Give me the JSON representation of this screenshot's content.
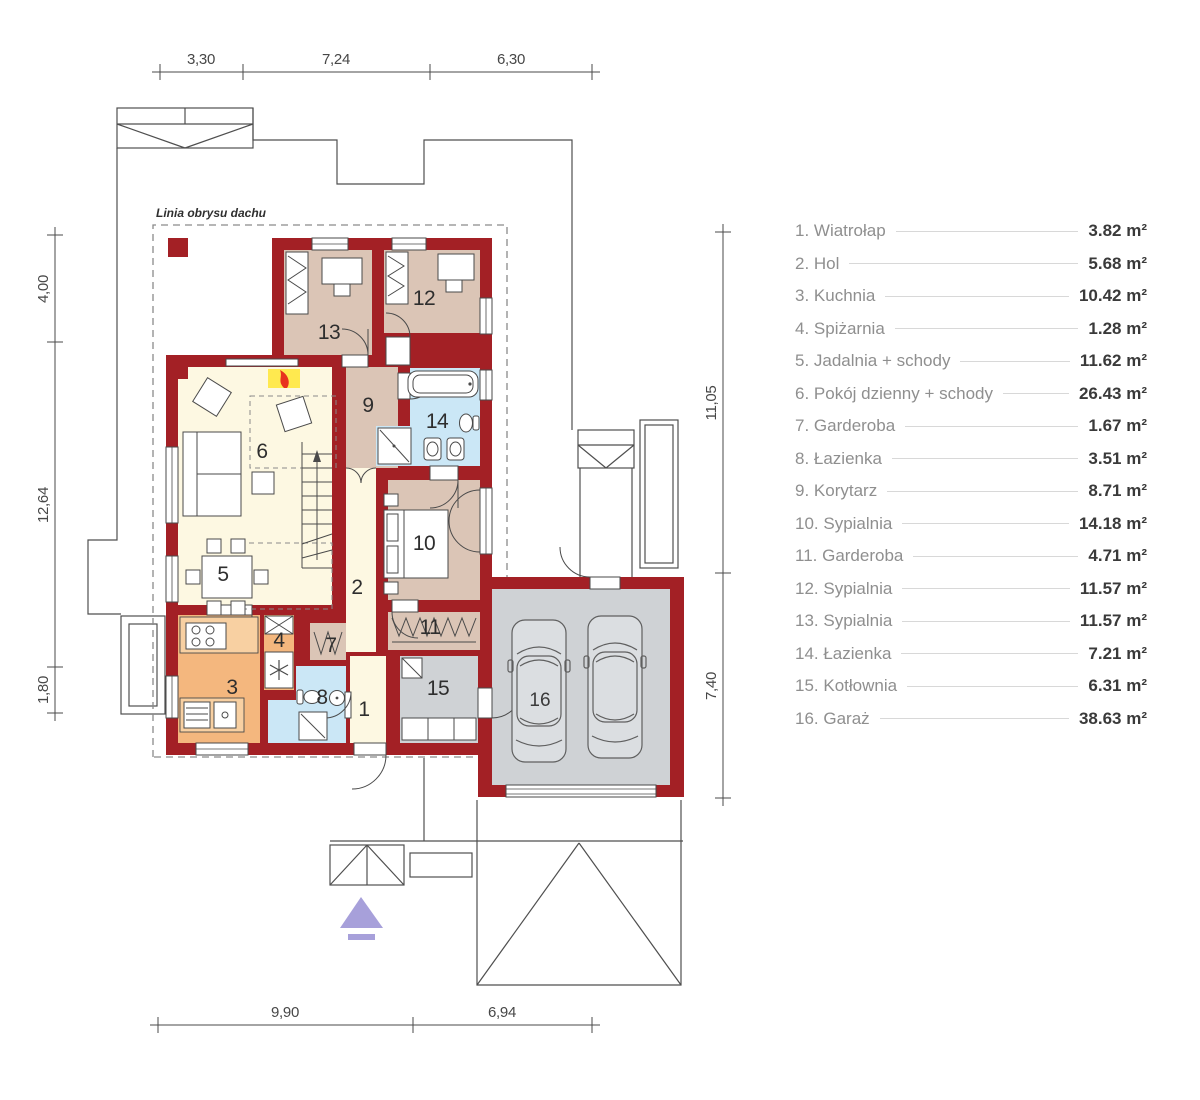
{
  "plan": {
    "roof_note": "Linia obrysu dachu",
    "room_numbers": [
      "1",
      "2",
      "3",
      "4",
      "5",
      "6",
      "7",
      "8",
      "9",
      "10",
      "11",
      "12",
      "13",
      "14",
      "15",
      "16"
    ]
  },
  "dims": {
    "top": [
      "3,30",
      "7,24",
      "6,30"
    ],
    "left": [
      "4,00",
      "12,64",
      "1,80"
    ],
    "right": [
      "11,05",
      "7,40"
    ],
    "bottom": [
      "9,90",
      "6,94"
    ]
  },
  "legend": {
    "items": [
      {
        "label": "1. Wiatrołap",
        "area": "3.82 m²"
      },
      {
        "label": "2. Hol",
        "area": "5.68 m²"
      },
      {
        "label": "3. Kuchnia",
        "area": "10.42 m²"
      },
      {
        "label": "4. Spiżarnia",
        "area": "1.28 m²"
      },
      {
        "label": "5. Jadalnia + schody",
        "area": "11.62 m²"
      },
      {
        "label": "6. Pokój dzienny + schody",
        "area": "26.43 m²"
      },
      {
        "label": "7. Garderoba",
        "area": "1.67 m²"
      },
      {
        "label": "8. Łazienka",
        "area": "3.51 m²"
      },
      {
        "label": "9. Korytarz",
        "area": "8.71 m²"
      },
      {
        "label": "10. Sypialnia",
        "area": "14.18 m²"
      },
      {
        "label": "11. Garderoba",
        "area": "4.71 m²"
      },
      {
        "label": "12. Sypialnia",
        "area": "11.57 m²"
      },
      {
        "label": "13. Sypialnia",
        "area": "11.57 m²"
      },
      {
        "label": "14. Łazienka",
        "area": "7.21 m²"
      },
      {
        "label": "15. Kotłownia",
        "area": "6.31 m²"
      },
      {
        "label": "16. Garaż",
        "area": "38.63 m²"
      }
    ]
  },
  "colors": {
    "wall": "#a32025",
    "bedroom": "#dbc5b6",
    "living": "#fdf8e2",
    "kitchen": "#f4b77e",
    "bath": "#cbe7f6",
    "garage": "#cfd2d5",
    "fireplace": "#ffe94f",
    "entrance_arrow": "#a7a0da"
  }
}
